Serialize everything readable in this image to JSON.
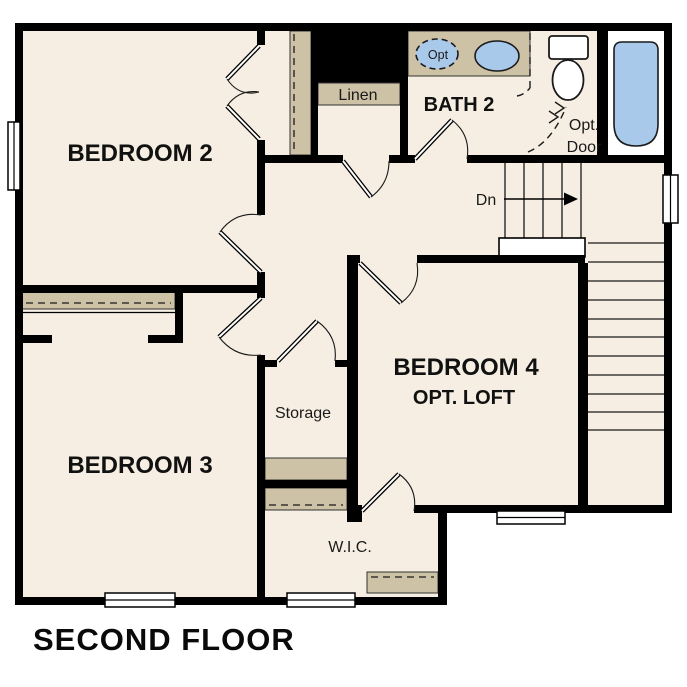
{
  "plan": {
    "title": "SECOND FLOOR",
    "rooms": {
      "bedroom2": "BEDROOM 2",
      "bedroom3": "BEDROOM 3",
      "bedroom4": "BEDROOM 4",
      "bedroom4_sub": "OPT. LOFT",
      "bath2": "BATH 2",
      "linen": "Linen",
      "storage": "Storage",
      "wic": "W.I.C."
    },
    "annotations": {
      "stair_direction": "Dn",
      "optional_door_line1": "Opt.",
      "optional_door_line2": "Door",
      "optional_sink": "Opt"
    },
    "colors": {
      "wall": "#000000",
      "floor": "#f6eee2",
      "cabinet": "#cdc1a6",
      "fixture_water": "#a9c9ea"
    }
  }
}
